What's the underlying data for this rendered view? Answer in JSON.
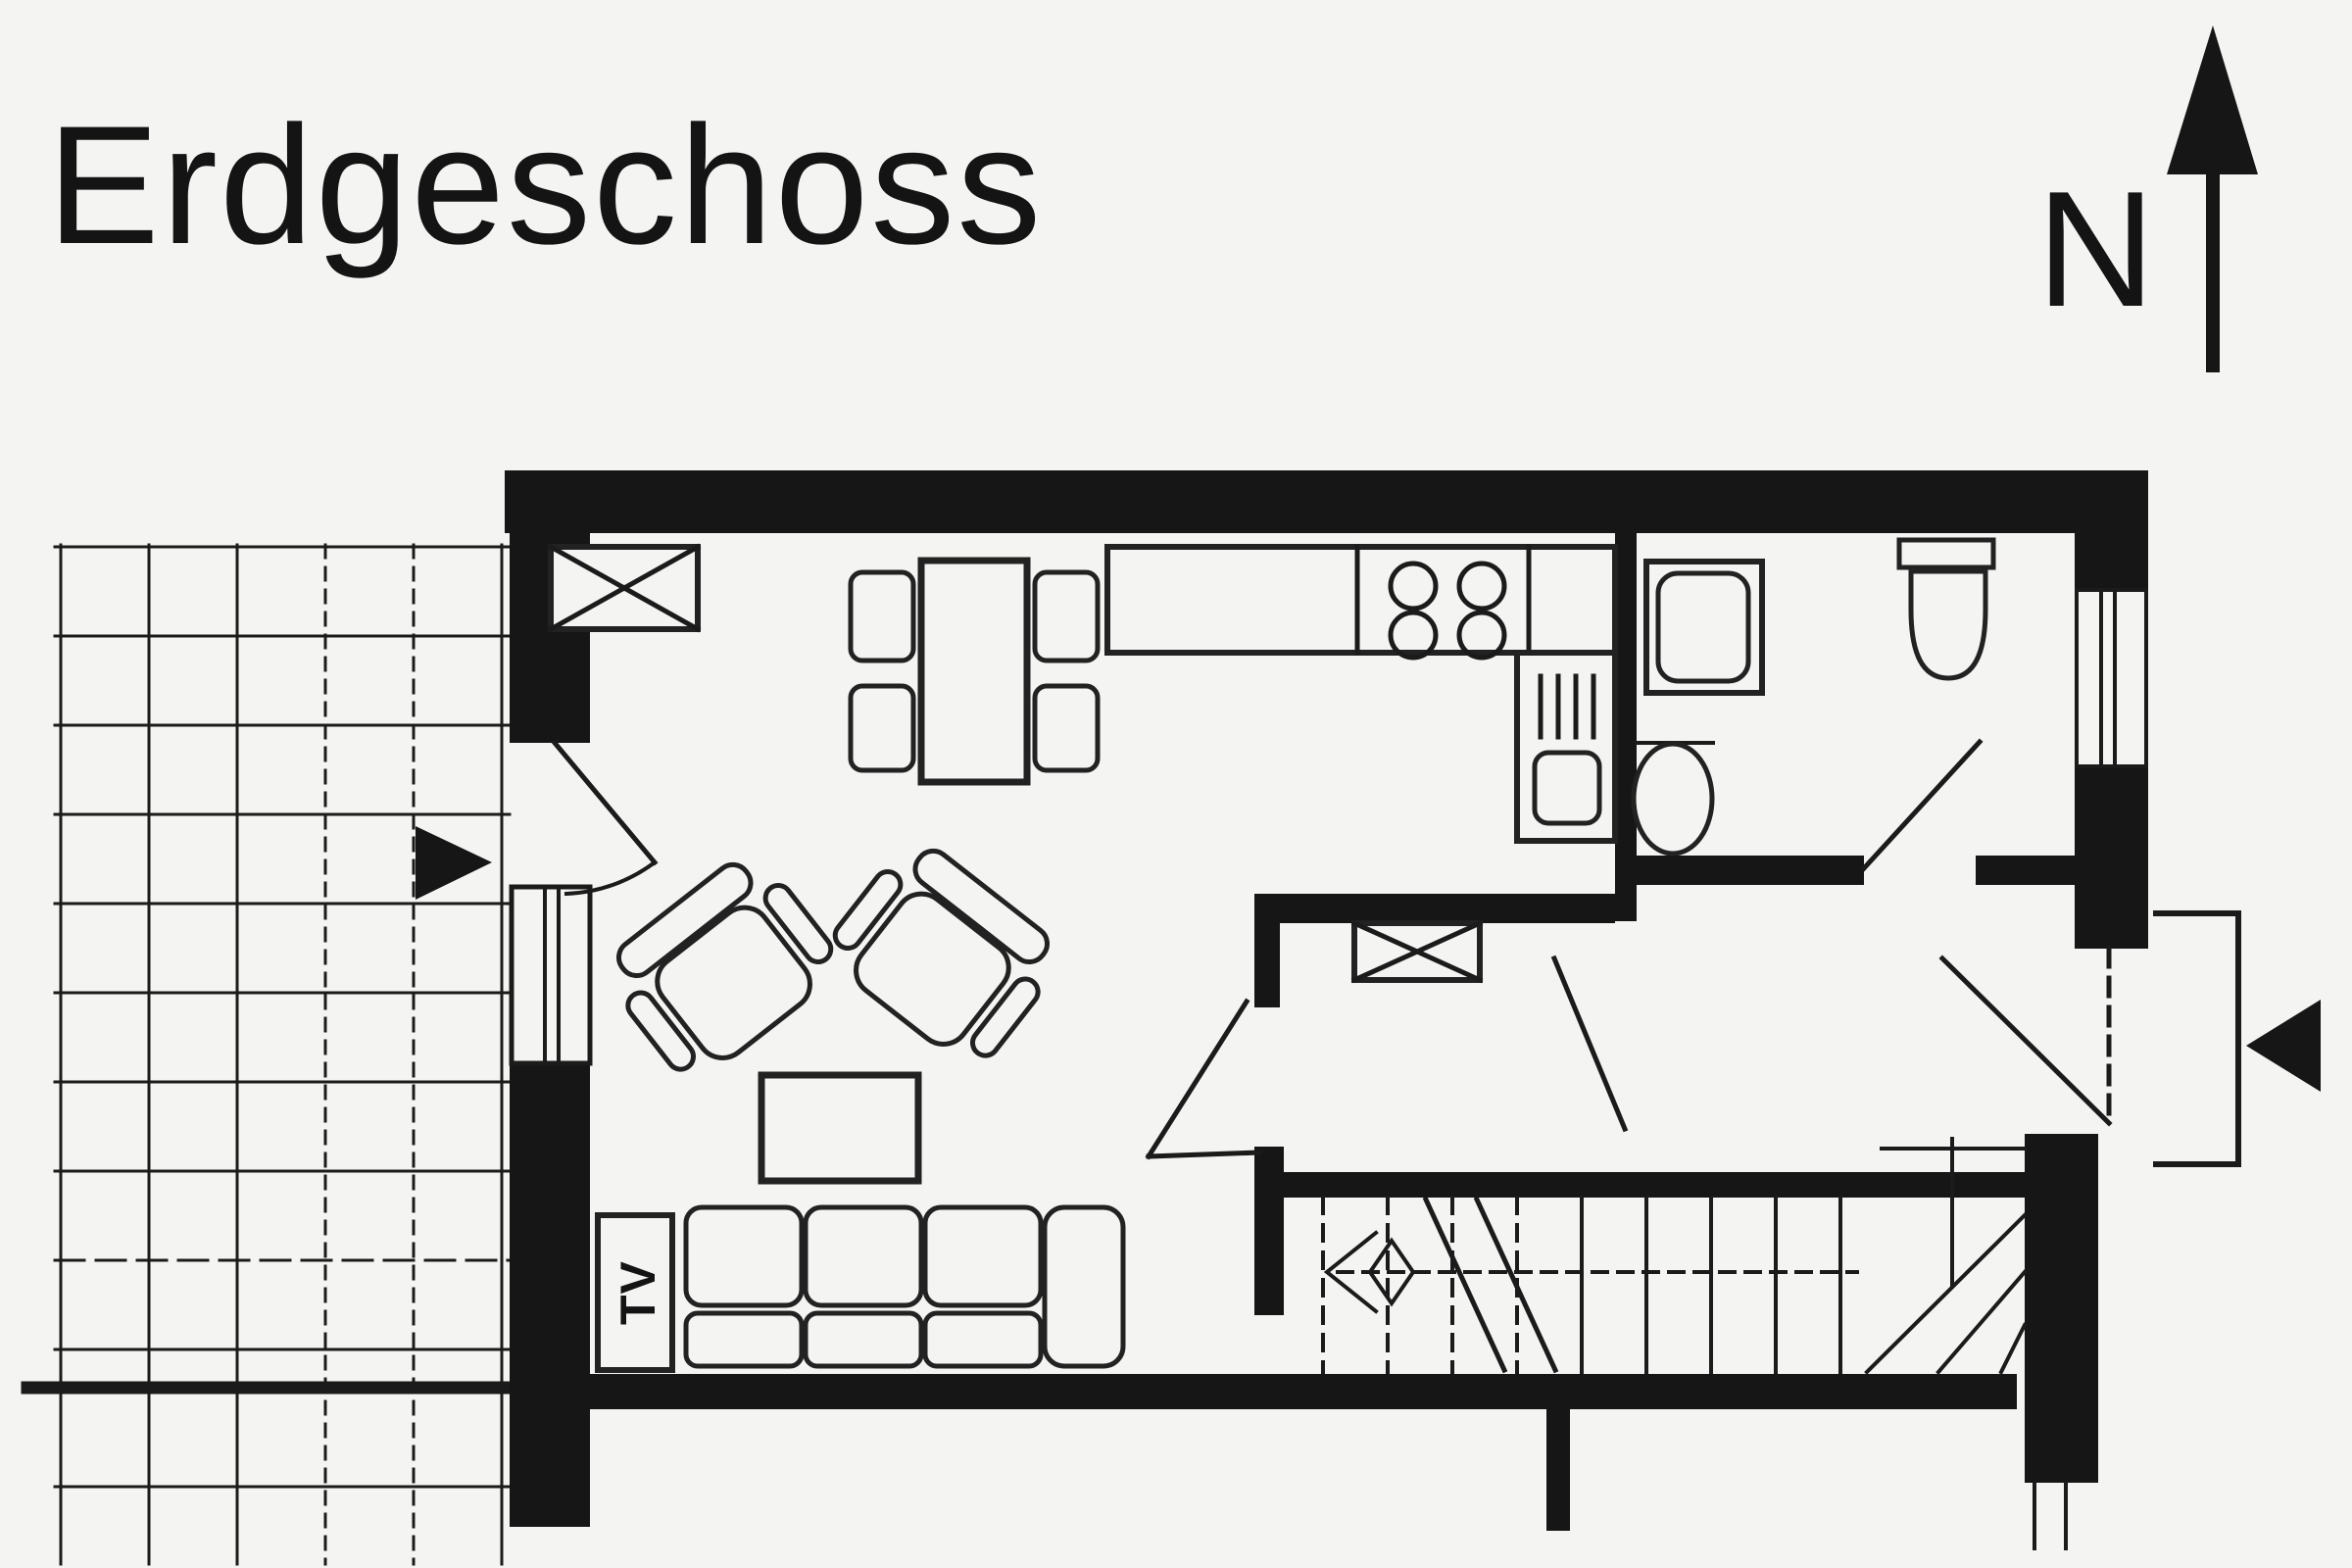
{
  "page": {
    "background_color": "#f4f4f2",
    "ink_color": "#161616",
    "kind": "floor-plan-drawing"
  },
  "title": {
    "text": "Erdgeschoss"
  },
  "compass": {
    "label": "N"
  },
  "living_room": {
    "tv_label": "TV"
  }
}
